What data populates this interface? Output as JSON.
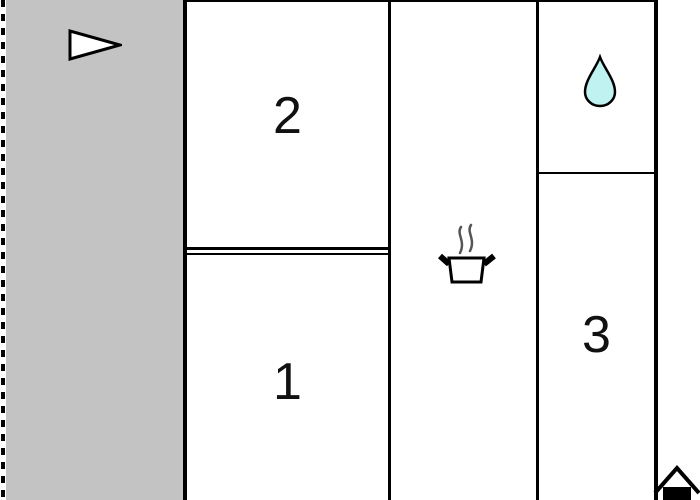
{
  "plan": {
    "title": "floor-plan",
    "rooms": {
      "room1": {
        "label": "1"
      },
      "room2": {
        "label": "2"
      },
      "room3": {
        "label": "3"
      }
    },
    "icons": {
      "terrace": "direction-arrow-icon",
      "bathroom": "water-drop-icon",
      "kitchen": "cooking-pot-icon",
      "entrance": "house-icon"
    },
    "colors": {
      "terrace_fill": "#c3c3c3",
      "water_drop_fill": "#bff2f0",
      "wall": "#000000",
      "steam": "#555555",
      "label_text": "#111111"
    }
  }
}
